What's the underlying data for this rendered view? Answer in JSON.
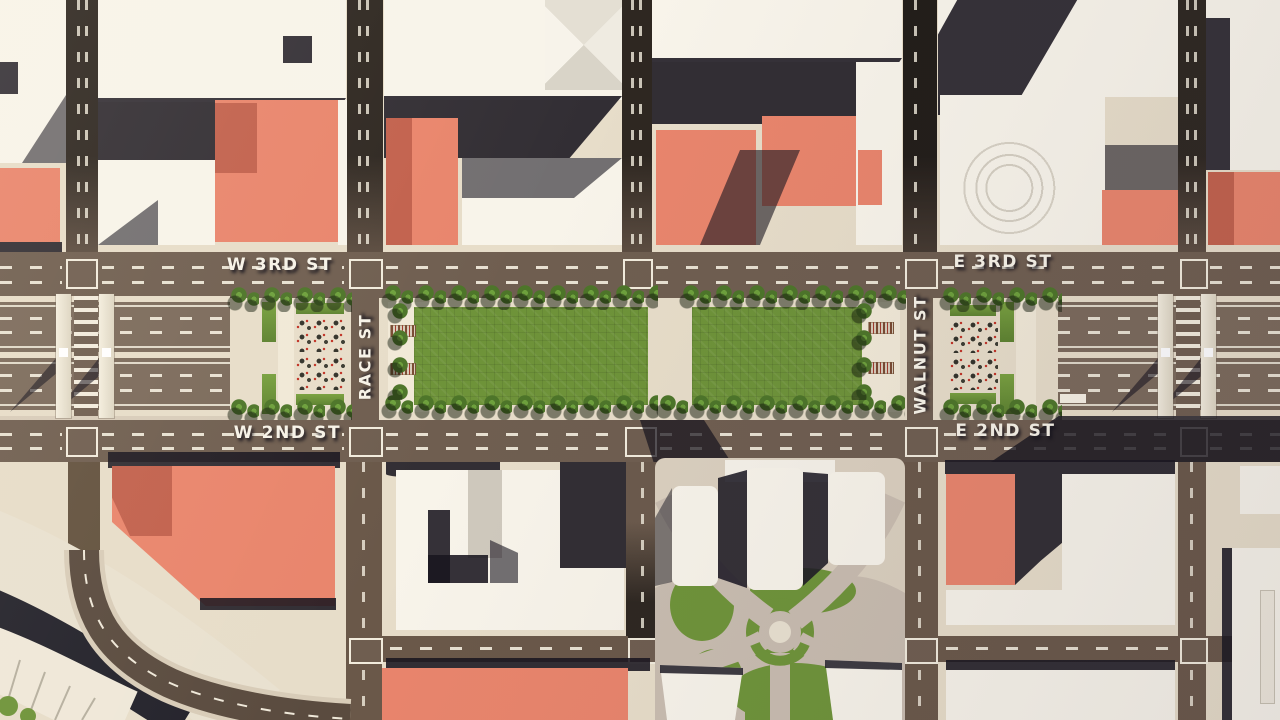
{
  "title": "Aerial 3D downtown render with highway cap parks",
  "streets": {
    "w_3rd": "W 3RD ST",
    "e_3rd": "E 3RD ST",
    "w_2nd": "W 2ND ST",
    "e_2nd": "E 2ND ST",
    "race": "RACE ST",
    "walnut": "WALNUT ST"
  },
  "colors": {
    "road": "#6f5e50",
    "roaddk": "#332b24",
    "sidewalk": "#e7ddc9",
    "block": "#d8ccba",
    "bldg": "#f8f4ea",
    "bldgsh": "#cfc9bd",
    "salmon": "#e9856c",
    "salmondk": "#c2614d",
    "shadow": "#1c1923",
    "lawn": "#6e9339",
    "tree": "#4d7529",
    "tree_light": "#6da03c",
    "mark": "#f2ecdd",
    "plaza": "#c9bdb0",
    "pathlight": "#f1e9d7"
  }
}
